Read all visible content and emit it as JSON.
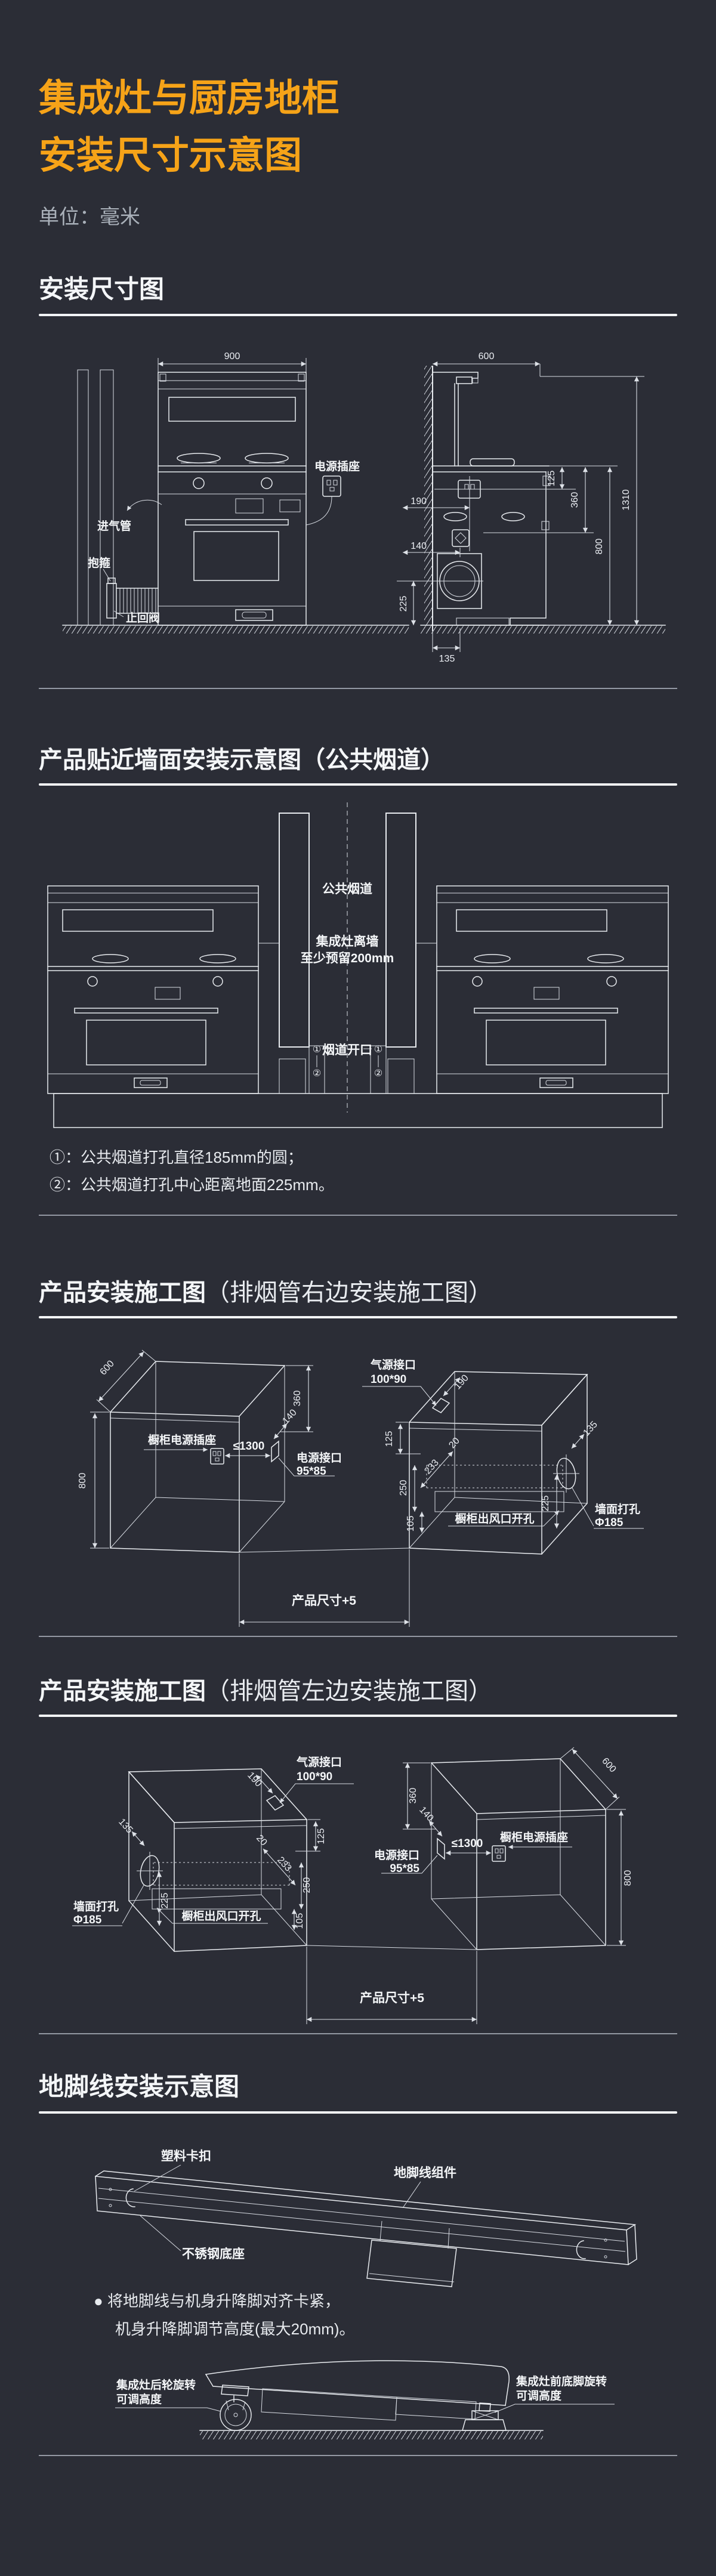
{
  "page": {
    "bg": "#2b2d36",
    "accent": "#f6a318",
    "line_color": "#e8ebef"
  },
  "header": {
    "title1": "集成灶与厨房地柜",
    "title2": "安装尺寸示意图",
    "unit": "单位：毫米"
  },
  "s1": {
    "heading": "安装尺寸图",
    "dims": {
      "w900": "900",
      "d600": "600",
      "h1310": "1310",
      "h800": "800",
      "h360": "360",
      "h125": "125",
      "d190": "190",
      "d140": "140",
      "h225": "225",
      "d135": "135"
    },
    "labels": {
      "socket": "电源插座",
      "gas_pipe": "进气管",
      "clamp": "抱箍",
      "check_valve": "止回阀"
    }
  },
  "s2": {
    "heading": "产品贴近墙面安装示意图（公共烟道）",
    "labels": {
      "flue": "公共烟道",
      "gap1": "集成灶离墙",
      "gap2": "至少预留200mm",
      "opening": "烟道开口",
      "m1": "①",
      "m2": "②"
    },
    "note1": "①：公共烟道打孔直径185mm的圆；",
    "note2": "②：公共烟道打孔中心距离地面225mm。"
  },
  "s3": {
    "heading_main": "产品安装施工图",
    "heading_sub": "（排烟管右边安装施工图）",
    "dims": {
      "d600": "600",
      "h800": "800",
      "h360": "360",
      "d140": "140",
      "max1300": "≤1300",
      "d190": "190",
      "h125": "125",
      "d20": "20",
      "d233": "233",
      "h250": "250",
      "h105": "105",
      "d135": "135",
      "h225": "225"
    },
    "labels": {
      "cab_socket": "橱柜电源插座",
      "power1": "电源接口",
      "power2": "95*85",
      "gas1": "气源接口",
      "gas2": "100*90",
      "outlet": "橱柜出风口开孔",
      "wall1": "墙面打孔",
      "wall2": "Φ185",
      "product": "产品尺寸+5"
    }
  },
  "s4": {
    "heading_main": "产品安装施工图",
    "heading_sub": "（排烟管左边安装施工图）",
    "dims": {
      "d600": "600",
      "h800": "800",
      "h360": "360",
      "d140": "140",
      "max1300": "≤1300",
      "d190": "190",
      "h125": "125",
      "d20": "20",
      "d233": "233",
      "h250": "250",
      "h105": "105",
      "d135": "135",
      "h225": "225"
    },
    "labels": {
      "cab_socket": "橱柜电源插座",
      "power1": "电源接口",
      "power2": "95*85",
      "gas1": "气源接口",
      "gas2": "100*90",
      "outlet": "橱柜出风口开孔",
      "wall1": "墙面打孔",
      "wall2": "Φ185",
      "product": "产品尺寸+5"
    }
  },
  "s5": {
    "heading": "地脚线安装示意图",
    "labels": {
      "clip": "塑料卡扣",
      "assembly": "地脚线组件",
      "base": "不锈钢底座",
      "rear1": "集成灶后轮旋转",
      "rear2": "可调高度",
      "front1": "集成灶前底脚旋转",
      "front2": "可调高度"
    },
    "bullet": "●",
    "note1": "将地脚线与机身升降脚对齐卡紧，",
    "note2": "机身升降脚调节高度(最大20mm)。"
  }
}
